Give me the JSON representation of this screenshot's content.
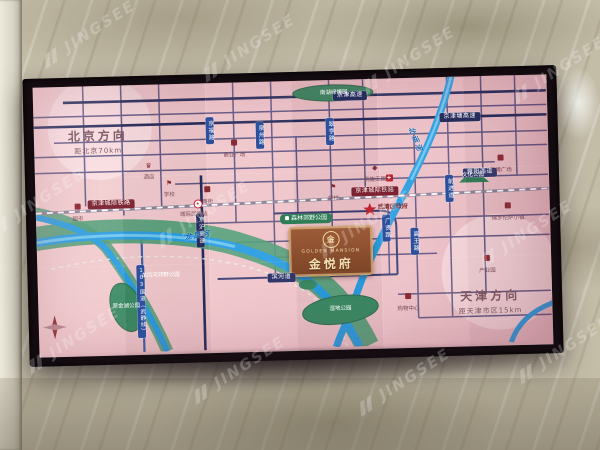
{
  "watermark": {
    "text": "JINGSEE"
  },
  "screen": {
    "directions": {
      "beijing_title": "北京方向",
      "beijing_sub": "距北京70km",
      "tianjin_title": "天津方向",
      "tianjin_sub": "距天津市区15km"
    },
    "project": {
      "logo_char": "金",
      "name_en": "GOLDEN MANSION",
      "name_cn": "金悦府"
    },
    "road_pills_h": [
      {
        "text": "京津高速"
      },
      {
        "text": "京津塘高速"
      },
      {
        "text": "雍阳西道"
      },
      {
        "text": "滨河道"
      }
    ],
    "road_pills_v": [
      {
        "text": "京福路"
      },
      {
        "text": "泉州路"
      },
      {
        "text": "翠亨路"
      },
      {
        "text": "前进道"
      },
      {
        "text": "广贤路"
      },
      {
        "text": "高王路"
      },
      {
        "text": "京沪高速"
      },
      {
        "text": "103国道（武静线）"
      }
    ],
    "railway": {
      "label": "京津城际铁路",
      "station": "城际武清站"
    },
    "rivers": [
      {
        "name": "龙凤河"
      },
      {
        "name": "北运河"
      }
    ],
    "parks": [
      {
        "label": "南湖绿博园"
      },
      {
        "label": "森林郊野公园"
      },
      {
        "label": "翠金湖公园"
      },
      {
        "label": "湿地公园"
      },
      {
        "label": "文化公园"
      },
      {
        "label": "龙凤河郊野公园"
      }
    ],
    "landmarks": {
      "government": "武清区政府"
    },
    "pois": [
      {
        "label": "酒店"
      },
      {
        "label": "学校"
      },
      {
        "label": "商业广场"
      },
      {
        "label": "凯旋王国"
      },
      {
        "label": "佛罗伦萨小镇"
      },
      {
        "label": "万博广场"
      },
      {
        "label": "医院"
      },
      {
        "label": "学校"
      },
      {
        "label": "购物中心"
      },
      {
        "label": "产业园"
      },
      {
        "label": "超市"
      },
      {
        "label": "商街"
      }
    ]
  }
}
